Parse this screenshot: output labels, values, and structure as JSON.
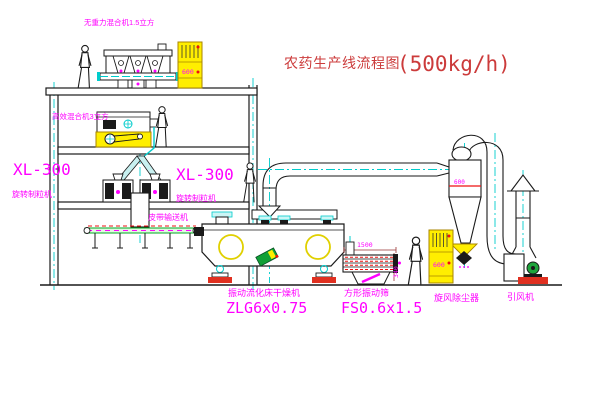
{
  "title": {
    "text_cn": "农药生产线流程图",
    "capacity": "(500kg/h)"
  },
  "labels": {
    "gravity_mixer": "无重力混合机1.5立方",
    "high_efficiency_mixer": "高效混合机3立方",
    "granulator_left_model": "XL-300",
    "granulator_left_name": "旋转制粒机",
    "granulator_mid_model": "XL-300",
    "granulator_mid_name": "旋转制粒机",
    "belt_conveyor": "皮带输送机",
    "dryer_name": "振动流化床干燥机",
    "dryer_model": "ZLG6x0.75",
    "sieve_name": "方形振动筛",
    "sieve_model": "FS0.6x1.5",
    "cyclone": "旋风除尘器",
    "fan": "引风机"
  },
  "dimensions": {
    "sieve_length": "1500",
    "sieve_height": "340"
  },
  "readings": {
    "cyclone_mark": "600",
    "cabinet_upper": "600",
    "cabinet_lower": "600"
  },
  "colors": {
    "line": "#1a1a1a",
    "centerline": "#00cccc",
    "label_magenta": "#ff00ff",
    "title_red": "#cc3b3b",
    "equipment_yellow": "#ffee00",
    "accent_red": "#ee1111",
    "belt_green": "#00aa22",
    "motor_green": "#1fa53c"
  }
}
